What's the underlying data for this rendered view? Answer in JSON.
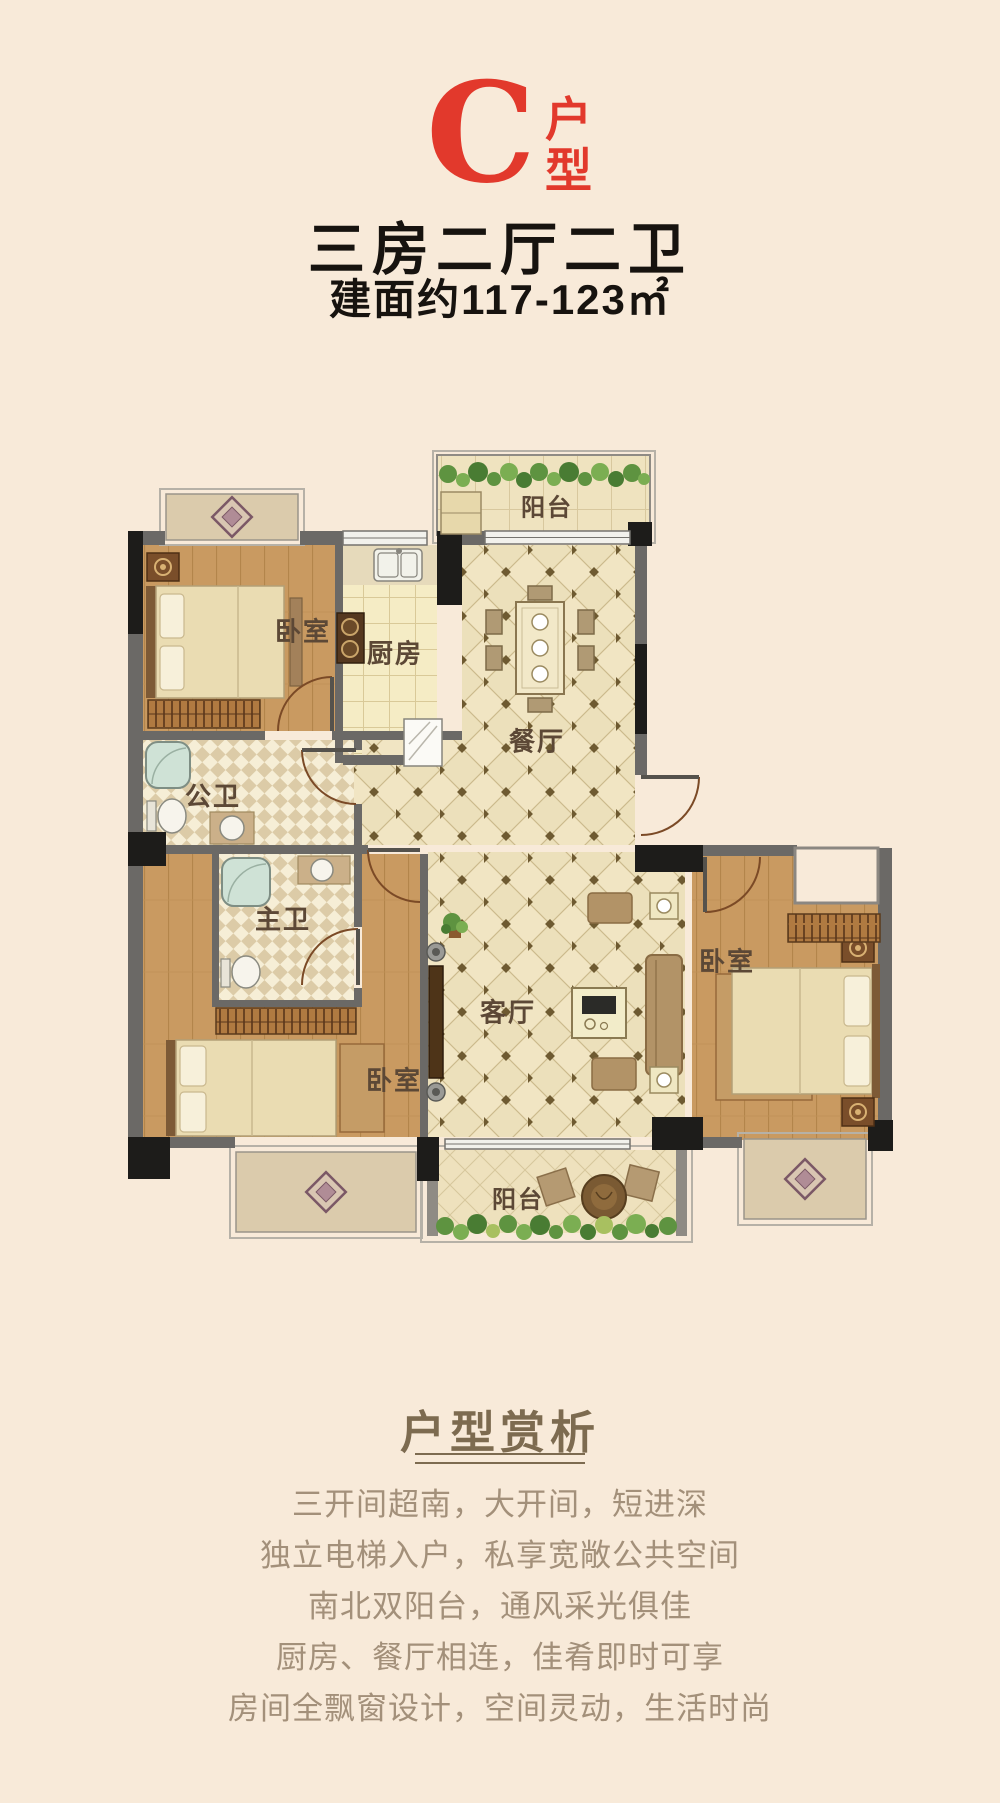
{
  "page": {
    "bg_color": "#f8ead9"
  },
  "header": {
    "unit_letter": "C",
    "unit_label_top": "户",
    "unit_label_bottom": "型",
    "accent_color": "#e2392c",
    "title": "三房二厅二卫",
    "area": "建面约117-123㎡",
    "text_color": "#17130f"
  },
  "floorplan": {
    "labels": {
      "balcony_north": "阳台",
      "bedroom_top": "卧室",
      "kitchen": "厨房",
      "dining": "餐厅",
      "bath_public": "公卫",
      "bath_master": "主卫",
      "bedroom_left": "卧室",
      "living": "客厅",
      "bedroom_right": "卧室",
      "balcony_south": "阳台"
    }
  },
  "analysis": {
    "heading": "户型赏析",
    "heading_color": "#7d6b50",
    "text_color": "#a3907a",
    "lines": [
      "三开间超南，大开间，短进深",
      "独立电梯入户，私享宽敞公共空间",
      "南北双阳台，通风采光俱佳",
      "厨房、餐厅相连，佳肴即时可享",
      "房间全飘窗设计，空间灵动，生活时尚"
    ]
  }
}
